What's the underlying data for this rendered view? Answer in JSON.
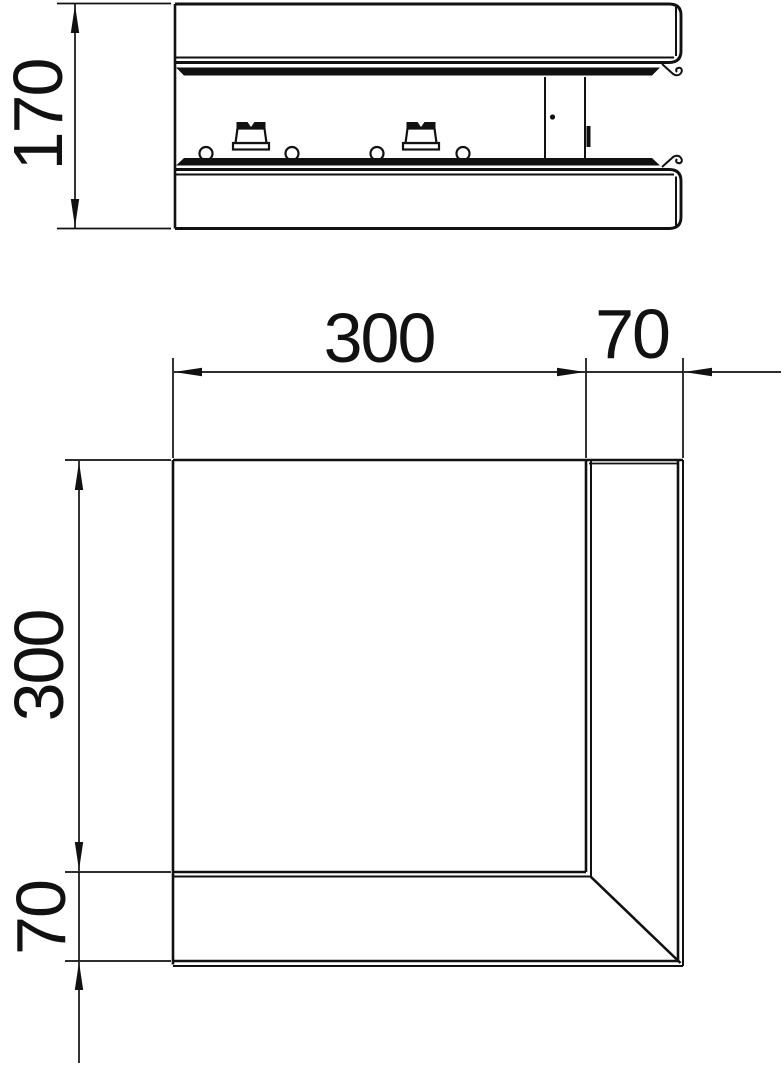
{
  "colors": {
    "ink": "#111111",
    "background": "#ffffff"
  },
  "side_view": {
    "dims": {
      "height": "170"
    }
  },
  "plan_view": {
    "dims": {
      "inner_width": "300",
      "wall_width": "70",
      "inner_height": "300",
      "wall_height": "70"
    }
  }
}
